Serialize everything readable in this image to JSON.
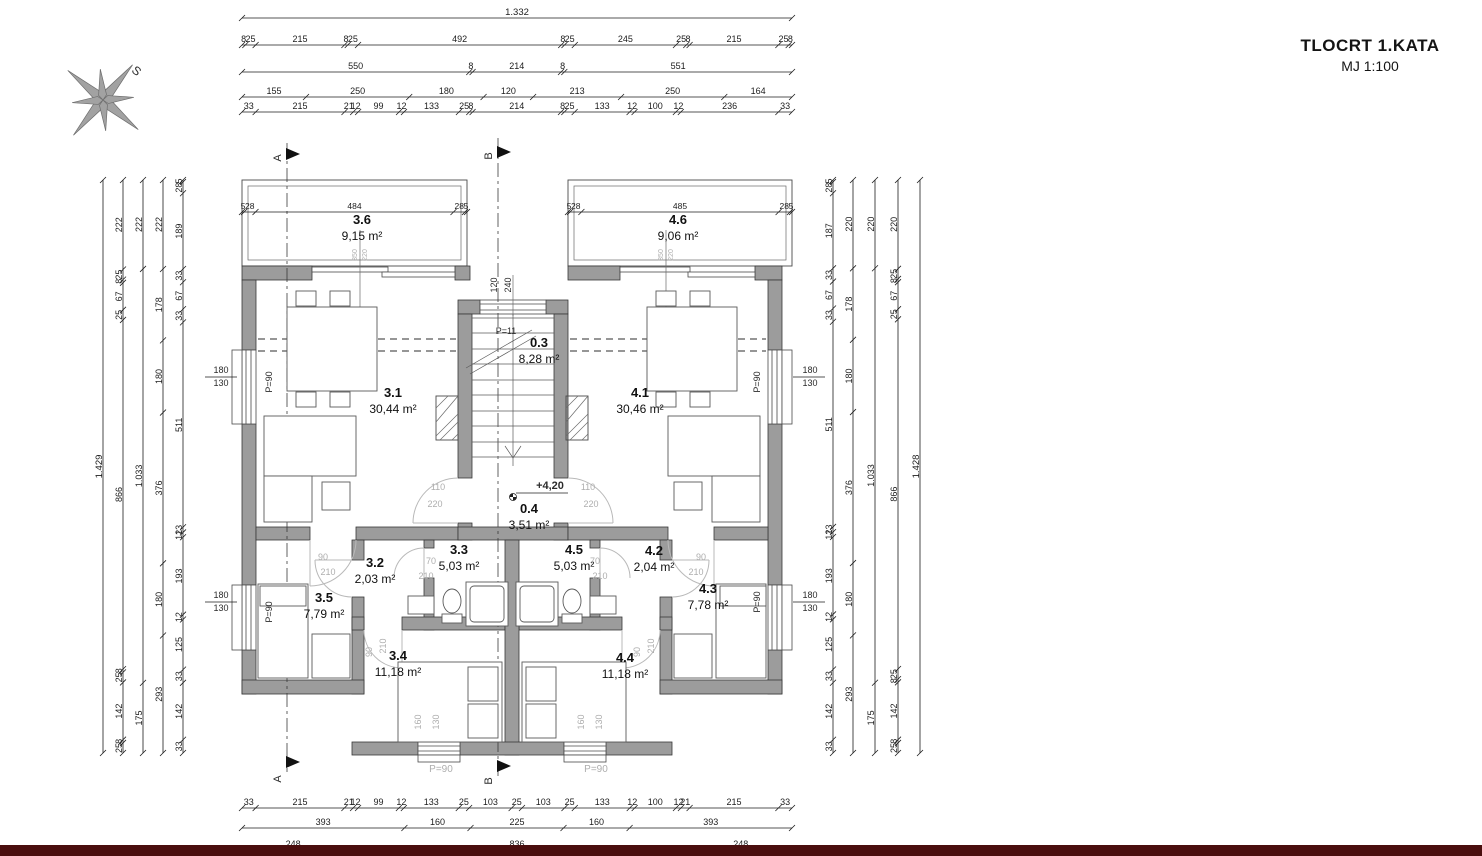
{
  "title": {
    "line1": "TLOCRT 1.KATA",
    "line2": "MJ 1:100"
  },
  "colors": {
    "wall_gray": "#9c9c9c",
    "accent_bar": "#4a0e0e",
    "gray_label": "#aeaeae"
  },
  "rooms": [
    {
      "id": "3.6",
      "area": "9,15 m²"
    },
    {
      "id": "4.6",
      "area": "9,06 m²"
    },
    {
      "id": "3.1",
      "area": "30,44 m²"
    },
    {
      "id": "4.1",
      "area": "30,46 m²"
    },
    {
      "id": "0.3",
      "area": "8,28 m²"
    },
    {
      "id": "0.4",
      "area": "3,51 m²"
    },
    {
      "id": "3.2",
      "area": "2,03 m²"
    },
    {
      "id": "3.3",
      "area": "5,03 m²"
    },
    {
      "id": "4.5",
      "area": "5,03 m²"
    },
    {
      "id": "4.2",
      "area": "2,04 m²"
    },
    {
      "id": "3.5",
      "area": "7,79 m²"
    },
    {
      "id": "4.3",
      "area": "7,78 m²"
    },
    {
      "id": "3.4",
      "area": "11,18 m²"
    },
    {
      "id": "4.4",
      "area": "11,18 m²"
    }
  ],
  "annotations": {
    "p90": "P=90",
    "p11": "P=11",
    "level": "+4,20",
    "w180": "180",
    "w130": "130",
    "w160": "160",
    "w120": "120",
    "w240": "240",
    "d90": "90",
    "d70": "70",
    "d210": "210",
    "d110": "110",
    "d220": "220",
    "d350": "350",
    "secA": "A",
    "secB": "B",
    "compass": "S"
  },
  "dims": {
    "top": [
      [
        "1.332"
      ],
      [
        "8",
        "25",
        "215",
        "8",
        "25",
        "492",
        "8",
        "25",
        "245",
        "25",
        "8",
        "215",
        "25",
        "8"
      ],
      [
        "550",
        "8",
        "214",
        "8",
        "551"
      ],
      [
        "155",
        "250",
        "180",
        "120",
        "213",
        "250",
        "164"
      ],
      [
        "33",
        "215",
        "21",
        "12",
        "99",
        "12",
        "133",
        "25",
        "8",
        "214",
        "8",
        "25",
        "133",
        "12",
        "100",
        "12",
        "236",
        "33"
      ]
    ],
    "bottom": [
      [
        "33",
        "215",
        "21",
        "12",
        "99",
        "12",
        "133",
        "25",
        "103",
        "25",
        "103",
        "25",
        "133",
        "12",
        "100",
        "12",
        "21",
        "215",
        "33"
      ],
      [
        "393",
        "160",
        "225",
        "160",
        "393"
      ],
      [
        "248",
        "836",
        "248"
      ]
    ],
    "left": [
      [
        "1.429"
      ],
      [
        "222",
        "25",
        "8",
        "67",
        "25",
        "866",
        "8",
        "25",
        "142",
        "8",
        "25"
      ],
      [
        "222",
        "1.033",
        "175"
      ],
      [
        "222",
        "178",
        "180",
        "376",
        "180",
        "293"
      ],
      [
        "5",
        "28",
        "189",
        "33",
        "67",
        "33",
        "511",
        "13",
        "12",
        "193",
        "12",
        "125",
        "33",
        "142",
        "33"
      ]
    ],
    "right": [
      [
        "5",
        "28",
        "187",
        "33",
        "67",
        "33",
        "511",
        "13",
        "12",
        "193",
        "12",
        "125",
        "33",
        "142",
        "33"
      ],
      [
        "220",
        "178",
        "180",
        "376",
        "180",
        "293"
      ],
      [
        "220",
        "1.033",
        "175"
      ],
      [
        "220",
        "25",
        "8",
        "67",
        "25",
        "866",
        "25",
        "8",
        "142",
        "8",
        "25"
      ],
      [
        "1.428"
      ]
    ],
    "terrace_left": [
      "5",
      "28",
      "484",
      "28",
      "5"
    ],
    "terrace_right": [
      "5",
      "28",
      "485",
      "28",
      "5"
    ]
  }
}
